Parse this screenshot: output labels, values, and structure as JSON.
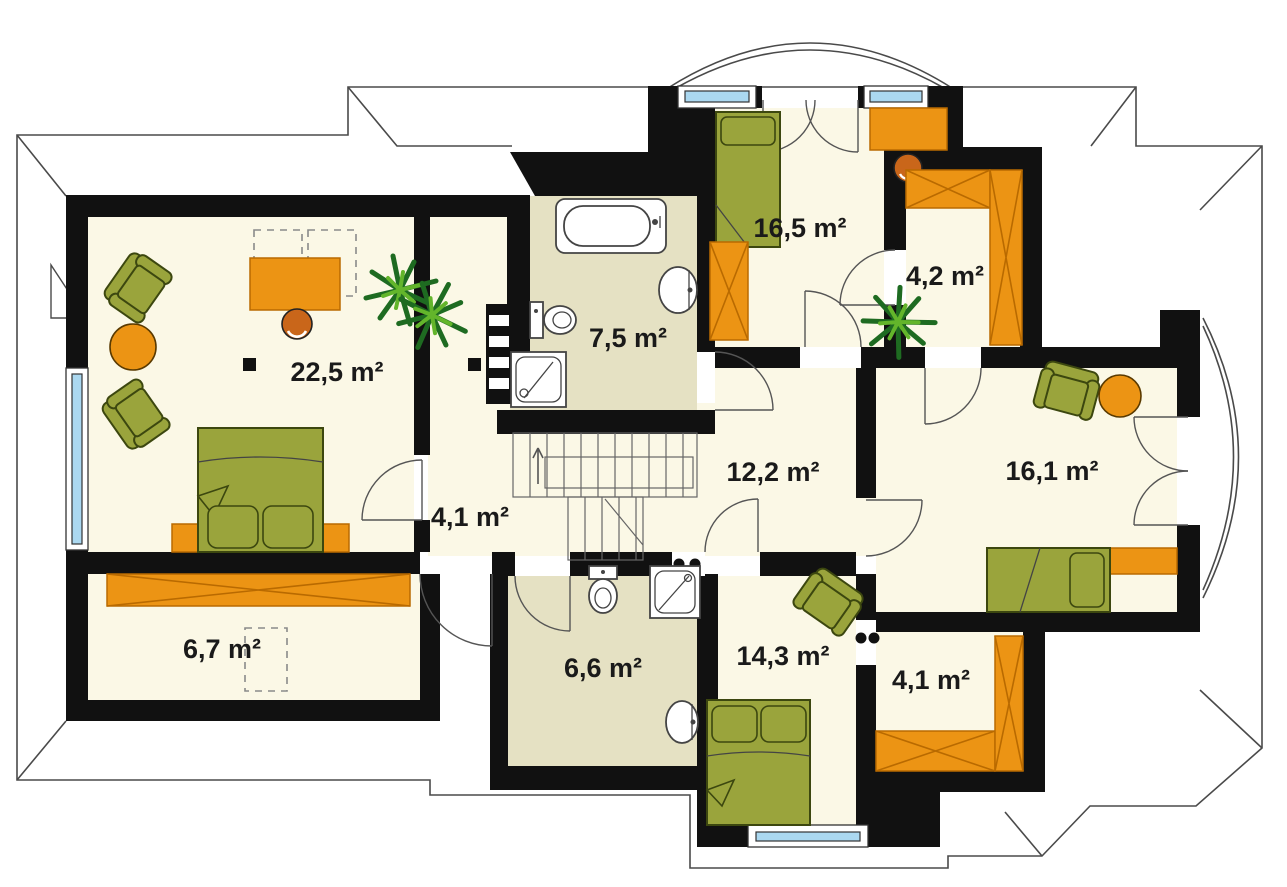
{
  "plan": {
    "type": "attic-floor-plan",
    "unit": "m²",
    "rooms": [
      {
        "id": "bedroom-large",
        "area_label": "22,5 m²"
      },
      {
        "id": "bathroom-upper",
        "area_label": "7,5 m²"
      },
      {
        "id": "bedroom-top",
        "area_label": "16,5 m²"
      },
      {
        "id": "closet-top",
        "area_label": "4,2 m²"
      },
      {
        "id": "hall-center",
        "area_label": "12,2 m²"
      },
      {
        "id": "room-right",
        "area_label": "16,1 m²"
      },
      {
        "id": "hall-landing",
        "area_label": "4,1 m²"
      },
      {
        "id": "storage-left",
        "area_label": "6,7 m²"
      },
      {
        "id": "bathroom-lower",
        "area_label": "6,6 m²"
      },
      {
        "id": "bedroom-bottom",
        "area_label": "14,3 m²"
      },
      {
        "id": "closet-bottom",
        "area_label": "4,1 m²"
      }
    ]
  },
  "palette": {
    "wall": "#111111",
    "floor": "#FBF8E6",
    "bath_floor": "#E5E1C3",
    "furniture_orange": "#EC9414",
    "furniture_orange_dark": "#C9661A",
    "orange_line": "#B96A00",
    "furniture_green": "#9AA43C",
    "furniture_green_dark": "#3C470F",
    "plant_dark": "#1E6B21",
    "plant_light": "#63B52B",
    "window_blue": "#ABD8F0",
    "roof_line": "#4a4a4a",
    "label": "#1a1a1a"
  }
}
